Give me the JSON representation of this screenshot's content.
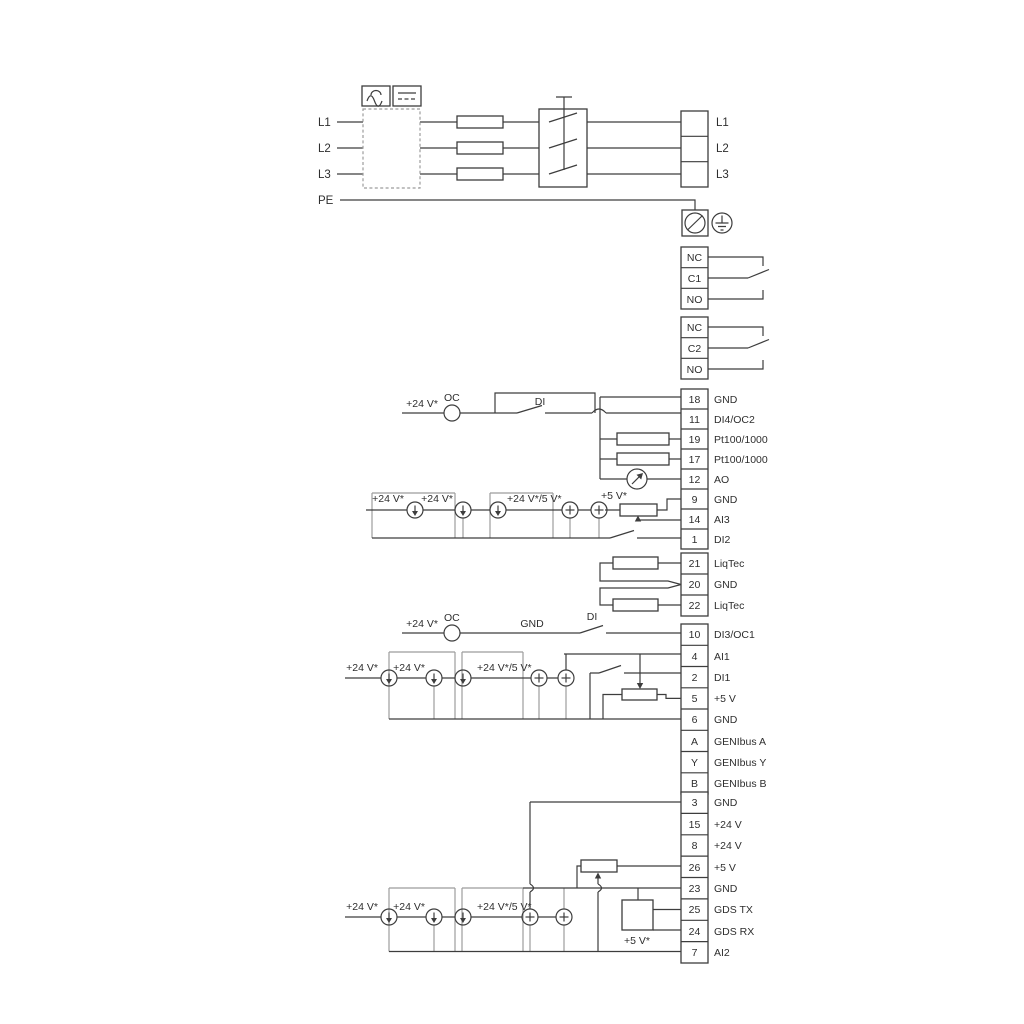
{
  "power": {
    "inputs": [
      "L1",
      "L2",
      "L3",
      "PE"
    ],
    "outputs": [
      "L1",
      "L2",
      "L3"
    ]
  },
  "relays": [
    {
      "rows": [
        "NC",
        "C1",
        "NO"
      ]
    },
    {
      "rows": [
        "NC",
        "C2",
        "NO"
      ]
    }
  ],
  "groups": [
    {
      "rows": [
        {
          "no": "18",
          "label": "GND"
        },
        {
          "no": "11",
          "label": "DI4/OC2"
        },
        {
          "no": "19",
          "label": "Pt100/1000"
        },
        {
          "no": "17",
          "label": "Pt100/1000"
        },
        {
          "no": "12",
          "label": "AO"
        },
        {
          "no": "9",
          "label": "GND"
        },
        {
          "no": "14",
          "label": "AI3"
        },
        {
          "no": "1",
          "label": "DI2"
        }
      ]
    },
    {
      "rows": [
        {
          "no": "21",
          "label": "LiqTec"
        },
        {
          "no": "20",
          "label": "GND"
        },
        {
          "no": "22",
          "label": "LiqTec"
        }
      ]
    },
    {
      "rows": [
        {
          "no": "10",
          "label": "DI3/OC1"
        },
        {
          "no": "4",
          "label": "AI1"
        },
        {
          "no": "2",
          "label": "DI1"
        },
        {
          "no": "5",
          "label": "+5 V"
        },
        {
          "no": "6",
          "label": "GND"
        },
        {
          "no": "A",
          "label": "GENIbus A"
        },
        {
          "no": "Y",
          "label": "GENIbus Y"
        },
        {
          "no": "B",
          "label": "GENIbus B"
        }
      ]
    },
    {
      "rows": [
        {
          "no": "3",
          "label": "GND"
        },
        {
          "no": "15",
          "label": "+24 V"
        },
        {
          "no": "8",
          "label": "+24 V"
        },
        {
          "no": "26",
          "label": "+5 V"
        },
        {
          "no": "23",
          "label": "GND"
        },
        {
          "no": "25",
          "label": "GDS TX"
        },
        {
          "no": "24",
          "label": "GDS RX"
        },
        {
          "no": "7",
          "label": "AI2"
        }
      ]
    }
  ],
  "ann": {
    "oc": "OC",
    "di": "DI",
    "gnd": "GND",
    "v24": "+24 V*",
    "v24_5": "+24 V*/5 V*",
    "v5": "+5 V*"
  },
  "colors": {
    "line": "#3d3d3d",
    "gray": "#9c9c9c",
    "text": "#2e2e2e"
  }
}
